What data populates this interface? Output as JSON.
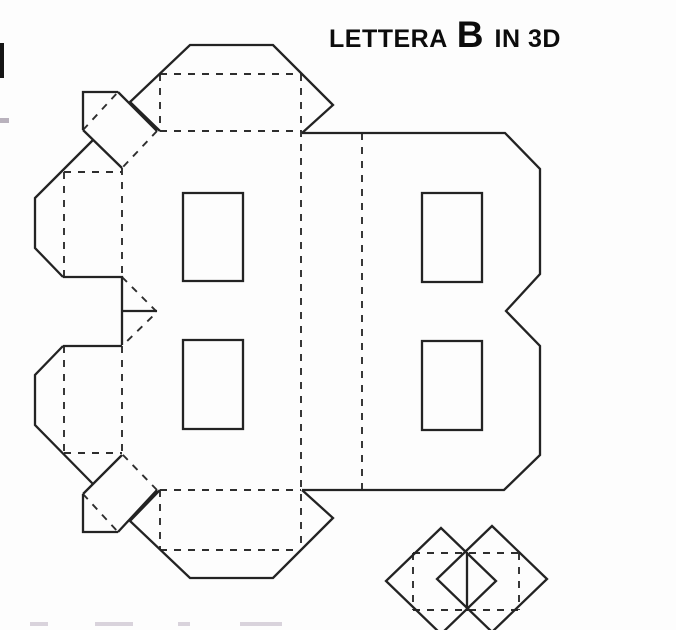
{
  "title": {
    "word1": "LETTERA",
    "letter": "B",
    "word2": "IN 3D"
  },
  "colors": {
    "background": "#fdfdfd",
    "cut_line": "#232323",
    "fold_line": "#2e2e2e",
    "title_text": "#0c0c0c",
    "scan_mark_black": "#151515",
    "scan_mark_gray": "#b9b2bd",
    "scan_smudge": "#d9d3dc"
  },
  "net": {
    "solid_cut_path": "M160 131 L130 102 L190 45 L273 45 L333 105 L302 133 M302 133 L505 133 L540 169 L540 274 L506 311 L540 346 L540 455 L504 490 L302 490 M302 490 L333 518 L273 578 L190 578 L130 521 L160 490 M63 277 L122 277 L122 345 M122 311 L157 311 M63 346 L122 346 M93 140 L35 198 L35 248 L63 277 M93 484 L35 425 L35 375 L63 346 M118 92 L157 131 M83 130 L122 168 M83 130 L83 92 L118 92 M118 532 L157 490 M83 494 L122 455 M83 494 L83 532 L118 532 M422 193 L482 193 L482 282 L422 282 Z M422 341 L482 341 L482 430 L422 430 Z M183 193 L243 193 L243 281 L183 281 Z M183 340 L243 340 L243 429 L183 429 Z M441 528 L386 581 L441 634 L496 581 Z M492 526 L437 579 L492 632 L547 579 Z M467 552 L467 611",
    "dashed_fold_path": "M301 74 L301 550 M362 133 L362 490 M160 74 L301 74 M160 131 L301 131 M160 74 L160 131 M160 490 L301 490 M160 550 L301 550 M160 490 L160 550 M157 131 L122 168 M83 130 L118 92 M157 490 L122 454 M83 494 L118 532 M122 168 L122 277 M64 172 L64 277 M64 172 L122 172 M122 346 L122 454 M64 346 L64 453 M64 453 L122 453 M122 277 L157 312 L122 346 M413 553 L519 553 M413 610 L519 610 M413 553 L413 610 M519 553 L519 610",
    "edge_mark_black_path": "M0 43 L4 43 L4 78 L0 78 Z",
    "edge_mark_gray_path": "M0 118 L9 118 L9 123 L0 123 Z",
    "bottom_smudges_path": "M30 622 L48 622 L48 626 L30 626 Z M95 622 L133 622 L133 626 L95 626 Z M178 622 L190 622 L190 626 L178 626 Z M240 622 L282 622 L282 626 L240 626 Z"
  }
}
